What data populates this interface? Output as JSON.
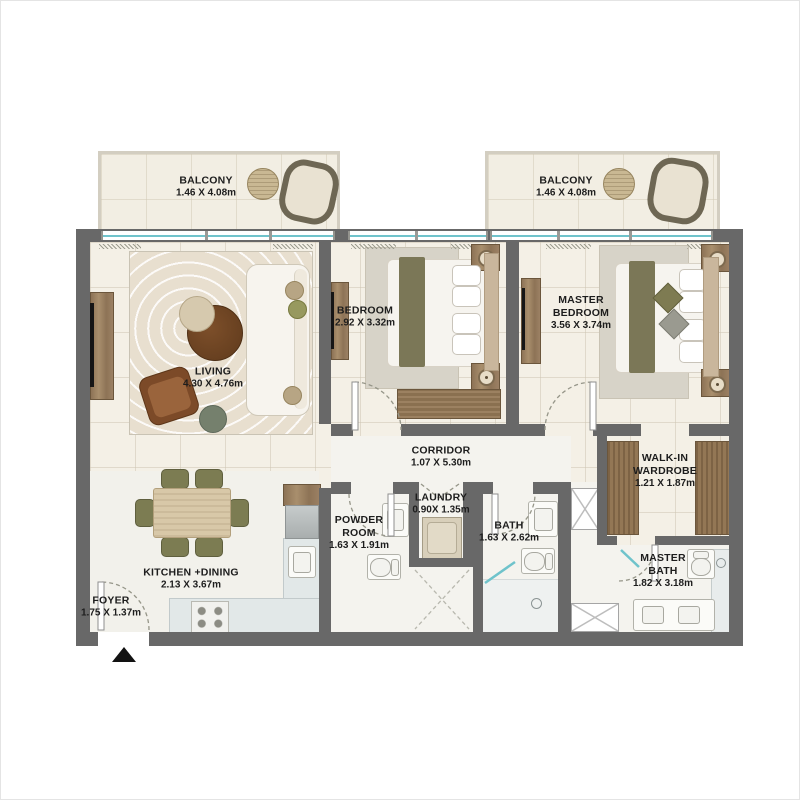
{
  "plan_title": "2 Bedroom Apartment Floor Plan",
  "rooms": {
    "balcony_left": {
      "name": "BALCONY",
      "dims": "1.46 X 4.08m"
    },
    "balcony_right": {
      "name": "BALCONY",
      "dims": "1.46 X 4.08m"
    },
    "living": {
      "name": "LIVING",
      "dims": "4.30 X 4.76m"
    },
    "bedroom": {
      "name": "BEDROOM",
      "dims": "2.92 X 3.32m"
    },
    "master_bedroom": {
      "name": "MASTER BEDROOM",
      "dims": "3.56 X 3.74m"
    },
    "corridor": {
      "name": "CORRIDOR",
      "dims": "1.07 X 5.30m"
    },
    "laundry": {
      "name": "LAUNDRY",
      "dims": "0.90X 1.35m"
    },
    "powder": {
      "name": "POWDER ROOM",
      "dims": "1.63 X 1.91m"
    },
    "bath": {
      "name": "BATH",
      "dims": "1.63 X 2.62m"
    },
    "walkin": {
      "name": "WALK-IN WARDROBE",
      "dims": "1.21 X 1.87m"
    },
    "master_bath": {
      "name": "MASTER BATH",
      "dims": "1.82 X 3.18m"
    },
    "kitchen": {
      "name": "KITCHEN +DINING",
      "dims": "2.13 X 3.67m"
    },
    "foyer": {
      "name": "FOYER",
      "dims": "1.75 X 1.37m"
    }
  },
  "colors": {
    "wall": "#686868",
    "floor_cream": "#f4f0e6",
    "floor_wet": "#f4f3ee",
    "window_glass": "#6fc3cb",
    "wood": "#a98f6d",
    "olive_fabric": "#7c7c52",
    "brown_leather": "#8a5431",
    "label_text": "#1d1d1d"
  }
}
